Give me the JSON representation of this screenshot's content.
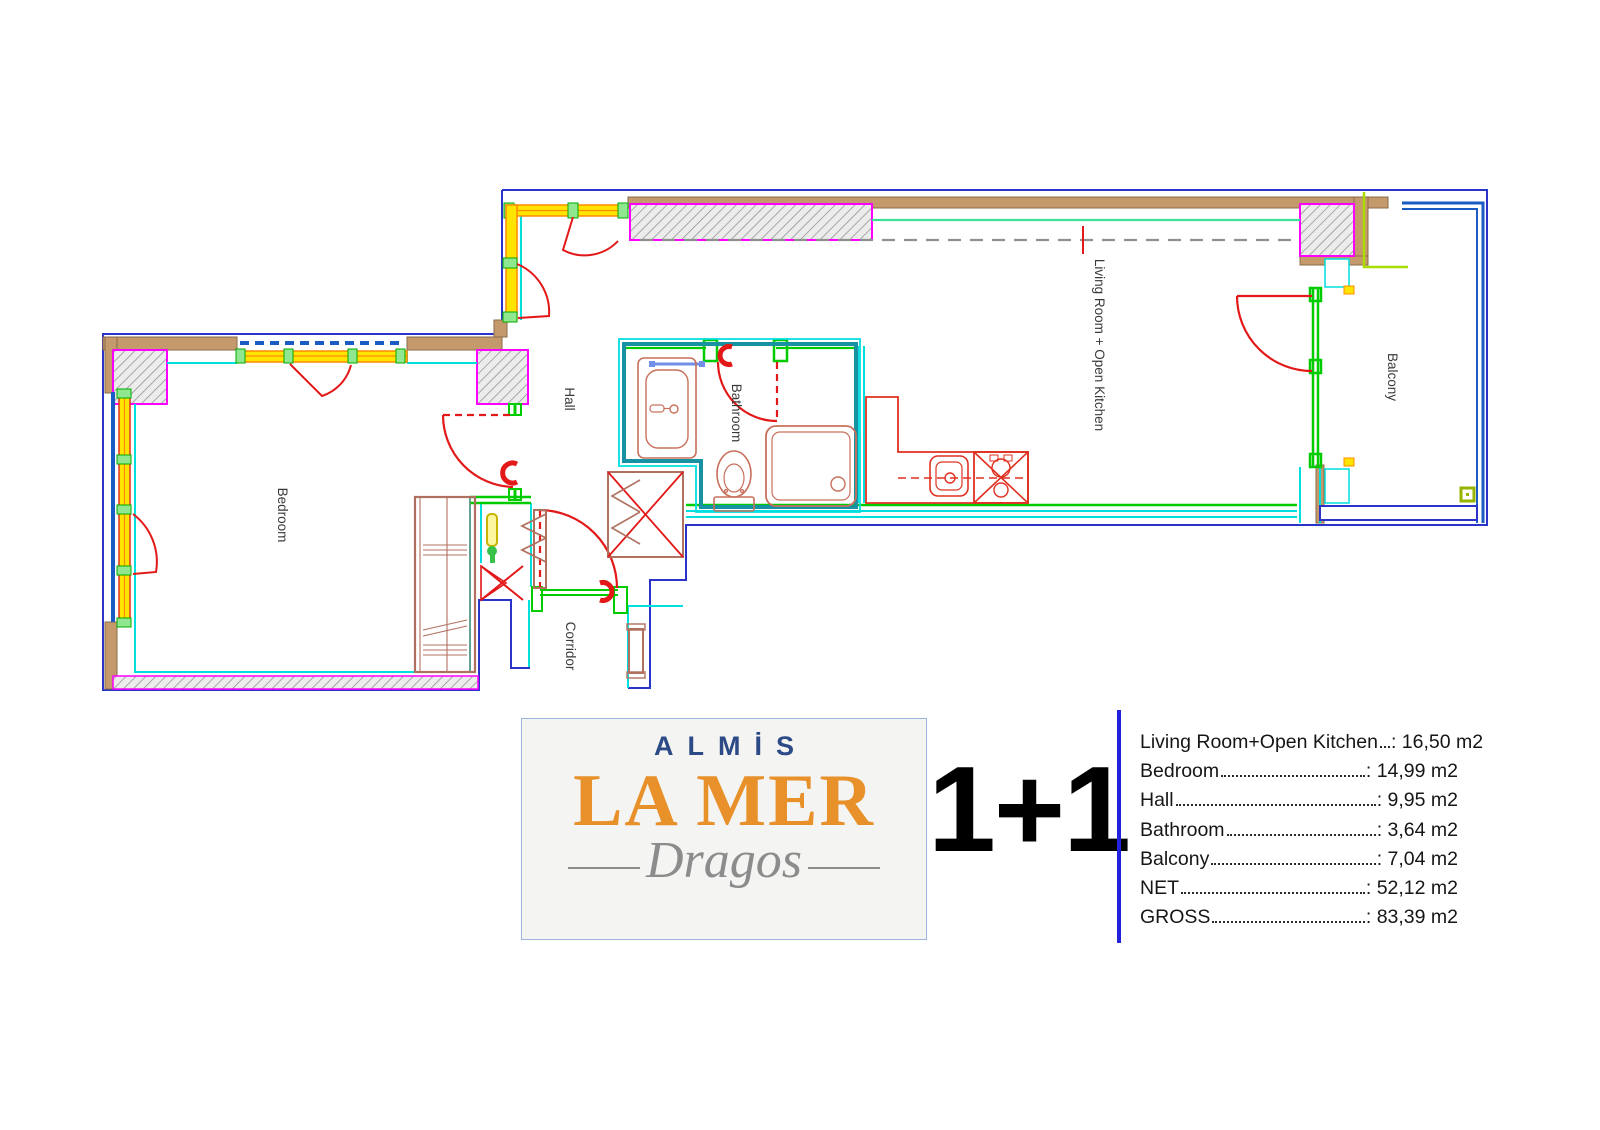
{
  "plan_type": "1+1",
  "logo": {
    "brand_top": "ALMİS",
    "brand_main": "LA MER",
    "brand_sub": "Dragos"
  },
  "rooms": {
    "bedroom": "Bedroom",
    "hall": "Hall",
    "bathroom": "Bathroom",
    "corridor": "Corridor",
    "living_room": "Living Room + Open Kitchen",
    "balcony": "Balcony"
  },
  "areas": {
    "colon": ":",
    "rows": [
      {
        "label": "Living Room+Open Kitchen",
        "value": "16,50 m2"
      },
      {
        "label": "Bedroom",
        "value": "14,99 m2"
      },
      {
        "label": "Hall",
        "value": "9,95 m2"
      },
      {
        "label": "Bathroom",
        "value": "3,64 m2"
      },
      {
        "label": "Balcony",
        "value": "7,04 m2"
      },
      {
        "label": "NET",
        "value": "52,12 m2"
      },
      {
        "label": "GROSS",
        "value": "83,39 m2"
      }
    ]
  },
  "colors": {
    "outline_blue": "#2a35c8",
    "railing_blue": "#1b5bc4",
    "wall_tan": "#c49a6c",
    "inner_cyan": "#00dede",
    "wall_green": "#00cc00",
    "mint_green": "#3ce098",
    "chartreuse": "#aadc00",
    "column_magenta": "#ff00ff",
    "window_yellow": "#ffe400",
    "window_orange": "#ff8c00",
    "door_red": "#e31818",
    "furniture_brown": "#b0705f",
    "bathroom_teal": "#1792a2",
    "hatch_gray": "#909090",
    "logo_navy": "#2b4a86",
    "logo_orange": "#e8912b",
    "logo_script_gray": "#8c8c8c",
    "table_rule_blue": "#2222dd"
  }
}
